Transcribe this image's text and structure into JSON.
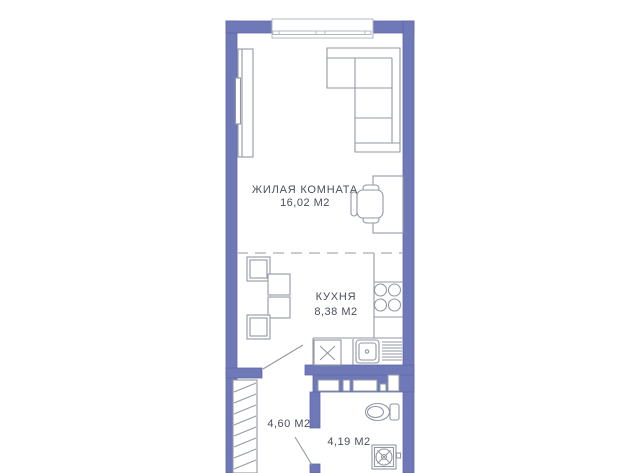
{
  "colors": {
    "wall": "#6f79b7",
    "wall_edge": "#5f69a8",
    "outline": "#9298a3",
    "window_outline": "#b3b8c0",
    "divider_dash": "#b5bac6",
    "text": "#4a4f5b",
    "background": "#ffffff"
  },
  "rooms": {
    "living": {
      "name": "ЖИЛАЯ КОМНАТА",
      "area": "16,02 М2"
    },
    "kitchen": {
      "name": "КУХНЯ",
      "area": "8,38 М2"
    },
    "hallway": {
      "area": "4,60 М2"
    },
    "bathroom": {
      "area": "4,19 М2"
    }
  },
  "fixtures": {
    "living": [
      "window",
      "wardrobe",
      "corner-sofa",
      "desk",
      "office-chair"
    ],
    "kitchen": [
      "dining-table",
      "dining-chairs",
      "hob-4-burners",
      "counter",
      "appliance-x-box",
      "sink",
      "dish-rack",
      "door-swing"
    ],
    "hallway": [
      "hatched-closet",
      "door-swing"
    ],
    "bathroom": [
      "toilet",
      "washing-machine",
      "duct-niches"
    ]
  }
}
